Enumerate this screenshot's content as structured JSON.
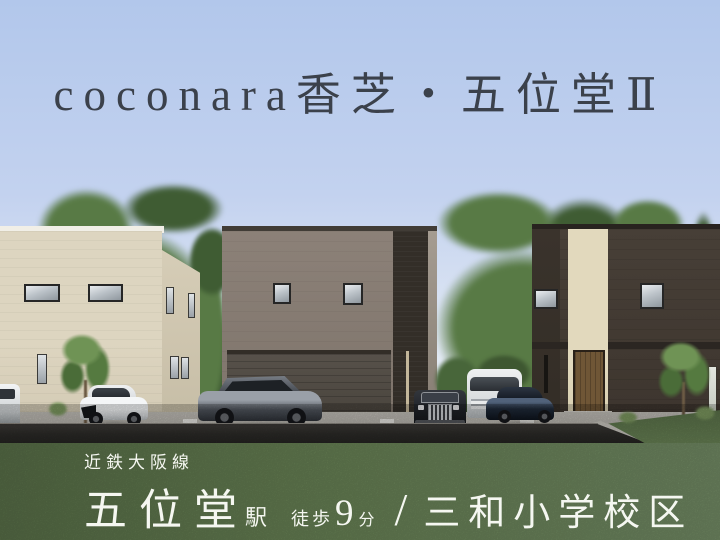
{
  "title": {
    "text": "coconara香芝・五位堂Ⅱ"
  },
  "footer": {
    "rail_line": "近鉄大阪線",
    "station_name": "五位堂",
    "station_suffix": "駅",
    "walk_label": "徒歩",
    "walk_minutes": "9",
    "walk_unit": "分",
    "separator": "/",
    "school_district": "三和小学校区"
  },
  "scene": {
    "houses": [
      {
        "id": "house-left",
        "exterior": "cream"
      },
      {
        "id": "house-middle",
        "exterior": "greige"
      },
      {
        "id": "house-right",
        "exterior": "dark-brown"
      }
    ],
    "vehicles": [
      "white-van-partial",
      "white-hatchback",
      "gray-suv",
      "black-classic-sedan",
      "white-minivan",
      "navy-coupe"
    ]
  },
  "colors": {
    "sky_top": "#b2c7eb",
    "sky_mid": "#c3d2ef",
    "sky_horizon": "#dfe7f3",
    "title_text": "#3b414b",
    "footer_text": "#f5f7f1",
    "grass_base": "#6d8859",
    "grass_dark": "#5c744b",
    "grass_light": "#78926a",
    "road": "#2d2c29",
    "concrete": "#b8b5ae",
    "cream_wall": "#ddd5c0",
    "cream_side": "#d6cdb7",
    "greige_wall": "#8c8178",
    "garage": "#57514a",
    "dark_accent": "#332e28",
    "brown_wall": "#473f37",
    "brown_side": "#3a332c",
    "cream_accent": "#e2d9bd",
    "door_wood": "#6f5636",
    "tree_green": "#587a45",
    "tree_dark": "#3f5c33",
    "hedge": "#3e5731",
    "frame": "#262626"
  }
}
